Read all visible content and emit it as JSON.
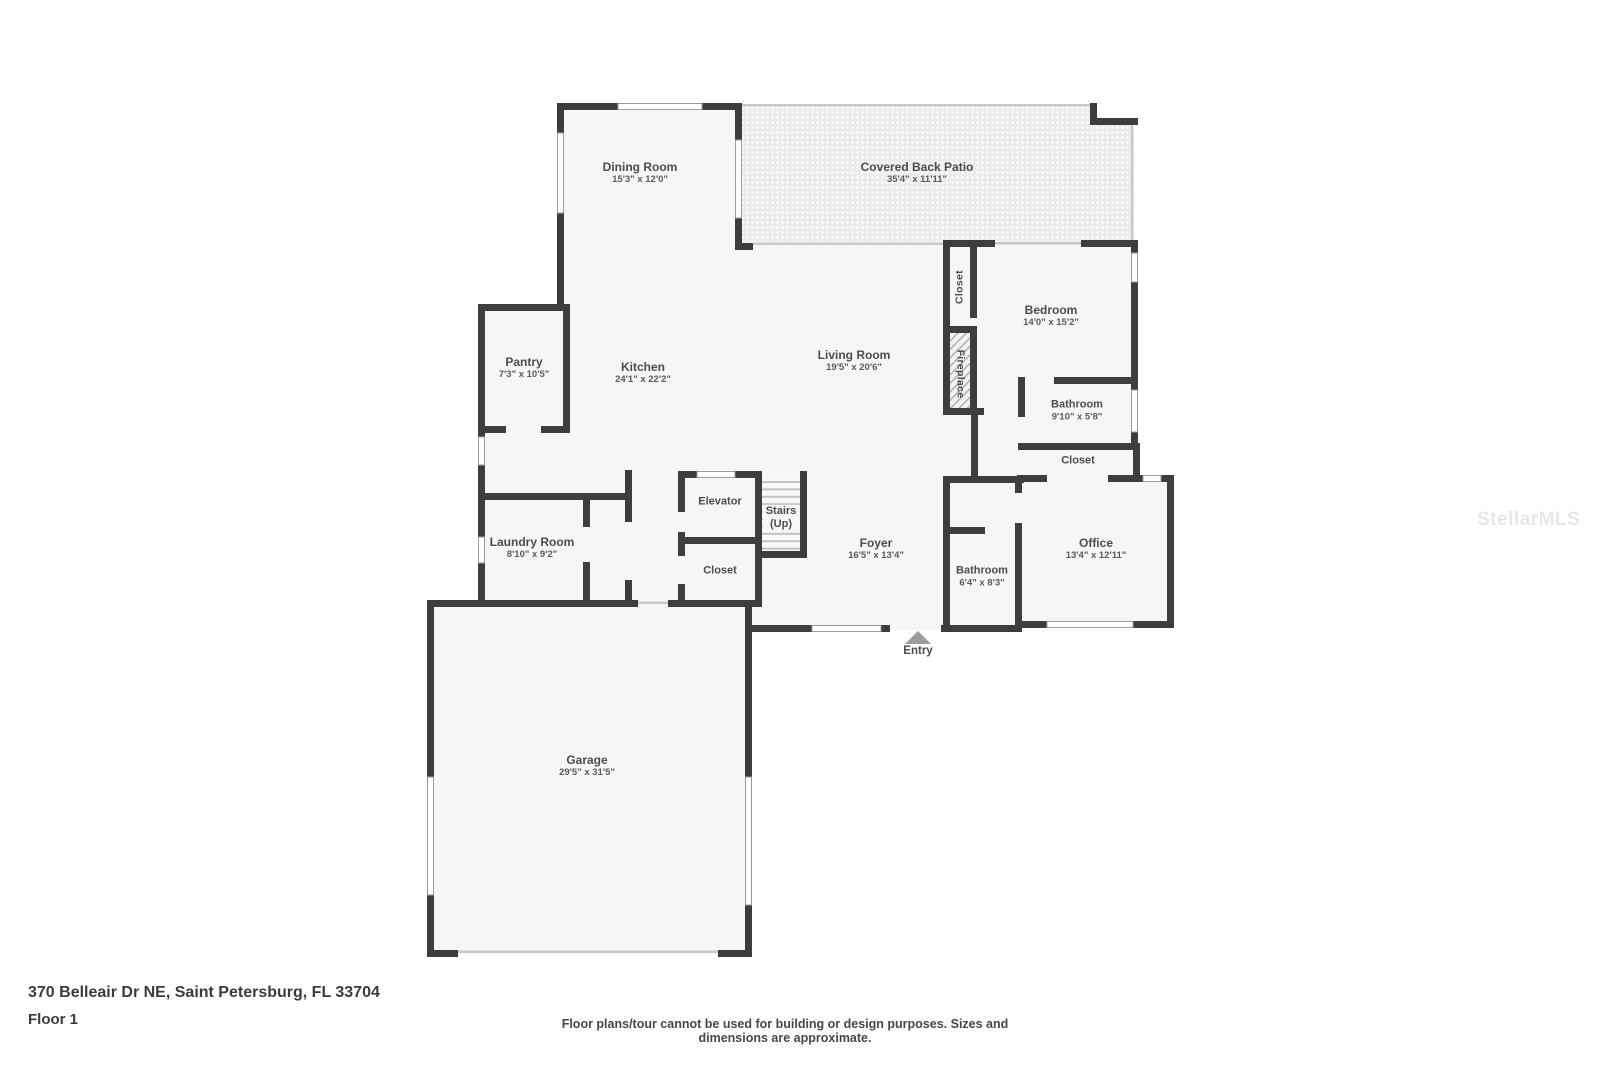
{
  "title": "Floor plan",
  "watermark": "StellarMLS",
  "footer": {
    "address": "370 Belleair Dr NE, Saint Petersburg, FL 33704",
    "floor": "Floor 1",
    "disclaimer": "Floor plans/tour cannot be used for building or design purposes. Sizes and dimensions are approximate."
  },
  "colors": {
    "wall": "#3d3d3d",
    "floor": "#f6f6f6",
    "patio_base": "#ebebeb",
    "thin_line": "#c9c9c9",
    "label_text": "#4c4c4c",
    "entry_marker": "#9d9d9d"
  },
  "rooms": [
    {
      "name": "Dining Room",
      "dims": "15'3\" x 12'0\""
    },
    {
      "name": "Covered Back Patio",
      "dims": "35'4\" x 11'11\""
    },
    {
      "name": "Closet"
    },
    {
      "name": "Fireplace"
    },
    {
      "name": "Bedroom",
      "dims": "14'0\" x 15'2\""
    },
    {
      "name": "Pantry",
      "dims": "7'3\" x 10'5\""
    },
    {
      "name": "Kitchen",
      "dims": "24'1\" x 22'2\""
    },
    {
      "name": "Living Room",
      "dims": "19'5\" x 20'6\""
    },
    {
      "name": "Bathroom",
      "dims": "9'10\" x 5'8\""
    },
    {
      "name": "Closet"
    },
    {
      "name": "Office",
      "dims": "13'4\" x 12'11\""
    },
    {
      "name": "Elevator"
    },
    {
      "name": "Stairs",
      "dims": "(Up)"
    },
    {
      "name": "Closet"
    },
    {
      "name": "Laundry Room",
      "dims": "8'10\" x 9'2\""
    },
    {
      "name": "Foyer",
      "dims": "16'5\" x 13'4\""
    },
    {
      "name": "Bathroom",
      "dims": "6'4\" x 8'3\""
    },
    {
      "name": "Garage",
      "dims": "29'5\" x 31'5\""
    },
    {
      "name": "Entry"
    }
  ]
}
